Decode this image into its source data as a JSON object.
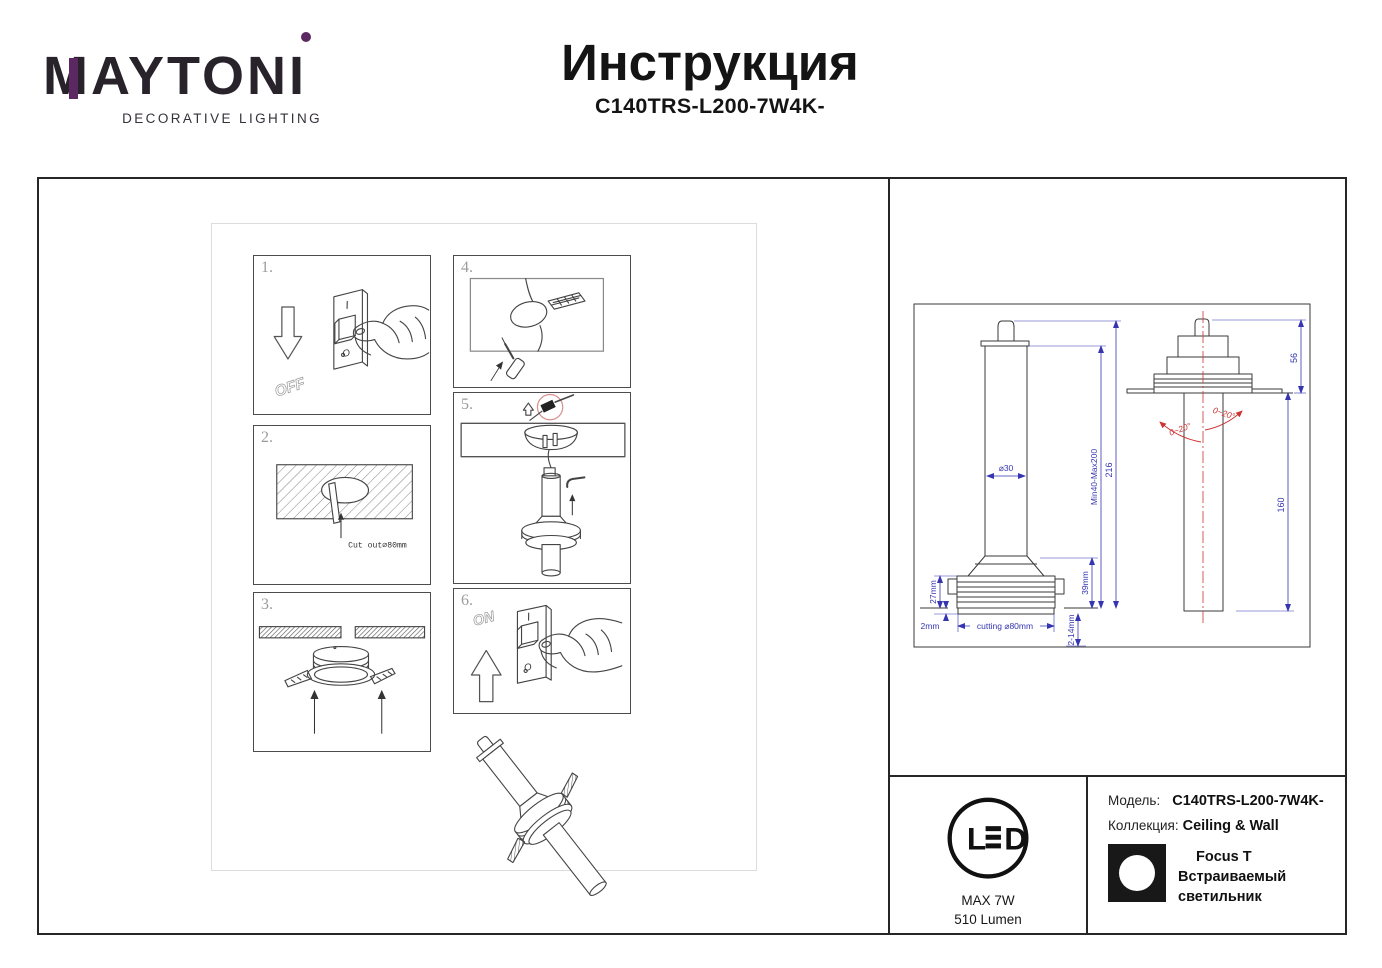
{
  "brand": {
    "name": "MAYTONI",
    "tagline": "DECORATIVE LIGHTING",
    "accent_color": "#5c2862"
  },
  "header": {
    "title": "Инструкция",
    "model": "C140TRS-L200-7W4K-"
  },
  "steps": {
    "s1": {
      "num": "1.",
      "arrow_label": "OFF",
      "switch_top": "I",
      "switch_bottom": "O"
    },
    "s2": {
      "num": "2.",
      "note": "Cut out⌀80mm"
    },
    "s3": {
      "num": "3."
    },
    "s4": {
      "num": "4."
    },
    "s5": {
      "num": "5."
    },
    "s6": {
      "num": "6.",
      "arrow_label": "ON",
      "switch_top": "I",
      "switch_bottom": "O"
    }
  },
  "drawing": {
    "dim_diameter": "⌀30",
    "dim_min_max": "Min40-Max200",
    "dim_total": "216",
    "dim_27": "27mm",
    "dim_2": "2mm",
    "dim_cutting": "cutting ⌀80mm",
    "dim_39": "39mm",
    "dim_2_14": "2-14mm",
    "dim_56": "56",
    "dim_160": "160",
    "tilt_left": "0~20°",
    "tilt_right": "0~20°",
    "dimension_color": "#3535b2",
    "centerline_color": "#cc3333",
    "line_color": "#3a3a3a"
  },
  "badge": {
    "led_l": "L",
    "led_d": "D",
    "max_power": "MAX 7W",
    "luminous_flux": "510 Lumen"
  },
  "product": {
    "model_label": "Модель:",
    "model_value": "C140TRS-L200-7W4K-",
    "collection_label": "Коллекция:",
    "collection_value": "Ceiling & Wall",
    "family": "Focus T",
    "type": "Встраиваемый светильник"
  }
}
